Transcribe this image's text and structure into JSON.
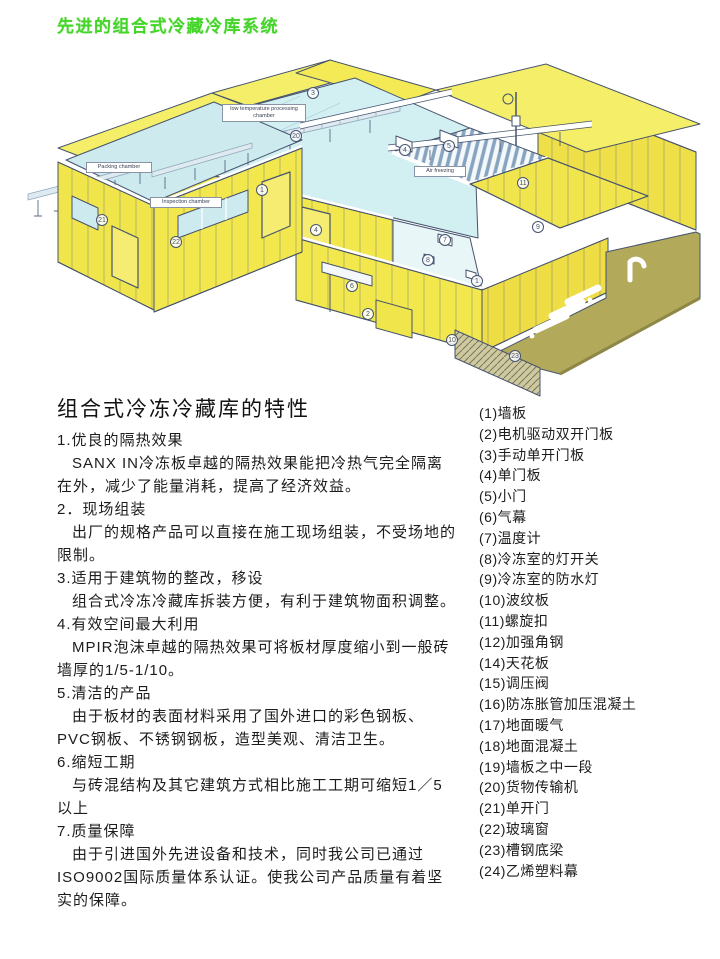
{
  "page_title": "先进的组合式冷藏冷库系统",
  "section_heading": "组合式冷冻冷藏库的特性",
  "features": [
    {
      "title": "1.优良的隔热效果",
      "body": "SANX IN冷冻板卓越的隔热效果能把冷热气完全隔离在外，减少了能量消耗，提高了经济效益。"
    },
    {
      "title": "2．现场组装",
      "body": "出厂的规格产品可以直接在施工现场组装，不受场地的限制。"
    },
    {
      "title": "3.适用于建筑物的整改，移设",
      "body": "组合式冷冻冷藏库拆装方便，有利于建筑物面积调整。"
    },
    {
      "title": "4.有效空间最大利用",
      "body": "MPIR泡沫卓越的隔热效果可将板材厚度缩小到一般砖墙厚的1/5-1/10。"
    },
    {
      "title": "5.清洁的产品",
      "body": "由于板材的表面材料采用了国外进口的彩色钢板、PVC钢板、不锈钢钢板，造型美观、清洁卫生。"
    },
    {
      "title": "6.缩短工期",
      "body": "与砖混结构及其它建筑方式相比施工工期可缩短1／5以上"
    },
    {
      "title": "7.质量保障",
      "body": "由于引进国外先进设备和技术，同时我公司已通过ISO9002国际质量体系认证。使我公司产品质量有着坚实的保障。"
    }
  ],
  "parts_list": [
    "(1)墙板",
    "(2)电机驱动双开门板",
    "(3)手动单开门板",
    "(4)单门板",
    "(5)小门",
    "(6)气幕",
    "(7)温度计",
    "(8)冷冻室的灯开关",
    "(9)冷冻室的防水灯",
    "(10)波纹板",
    "(11)螺旋扣",
    "(12)加强角钢",
    "(14)天花板",
    "(15)调压阀",
    "(16)防冻胀管加压混凝土",
    "(17)地面暖气",
    "(18)地面混凝土",
    "(19)墙板之中一段",
    "(20)货物传输机",
    "(21)单开门",
    "(22)玻璃窗",
    "(23)槽钢底梁",
    "(24)乙烯塑料幕"
  ],
  "illustration": {
    "chamber_labels": [
      {
        "text": "Packing chamber",
        "x": 86,
        "y": 162,
        "w": 66
      },
      {
        "text": "Inspection chamber",
        "x": 150,
        "y": 197,
        "w": 72
      },
      {
        "text": "low temperature processing chamber",
        "x": 222,
        "y": 104,
        "w": 84
      },
      {
        "text": "Air freezing",
        "x": 414,
        "y": 166,
        "w": 52
      }
    ],
    "part_markers": [
      {
        "n": "3",
        "x": 313,
        "y": 93
      },
      {
        "n": "4",
        "x": 405,
        "y": 150
      },
      {
        "n": "5",
        "x": 449,
        "y": 146
      },
      {
        "n": "20",
        "x": 296,
        "y": 136
      },
      {
        "n": "1",
        "x": 262,
        "y": 190
      },
      {
        "n": "4",
        "x": 316,
        "y": 230
      },
      {
        "n": "11",
        "x": 523,
        "y": 183
      },
      {
        "n": "9",
        "x": 538,
        "y": 227
      },
      {
        "n": "7",
        "x": 445,
        "y": 240
      },
      {
        "n": "8",
        "x": 428,
        "y": 260
      },
      {
        "n": "1",
        "x": 477,
        "y": 281
      },
      {
        "n": "6",
        "x": 352,
        "y": 286
      },
      {
        "n": "2",
        "x": 368,
        "y": 314
      },
      {
        "n": "10",
        "x": 452,
        "y": 340
      },
      {
        "n": "23",
        "x": 515,
        "y": 356
      },
      {
        "n": "21",
        "x": 102,
        "y": 220
      },
      {
        "n": "22",
        "x": 176,
        "y": 242
      }
    ],
    "colors": {
      "title_green": "#45d42a",
      "panel_yellow": "#f2e84e",
      "floor_cyan": "#cdeaee",
      "dock_olive": "#b2a95b",
      "outline_navy": "#46536e",
      "steel_blue": "#9db8cc"
    }
  }
}
